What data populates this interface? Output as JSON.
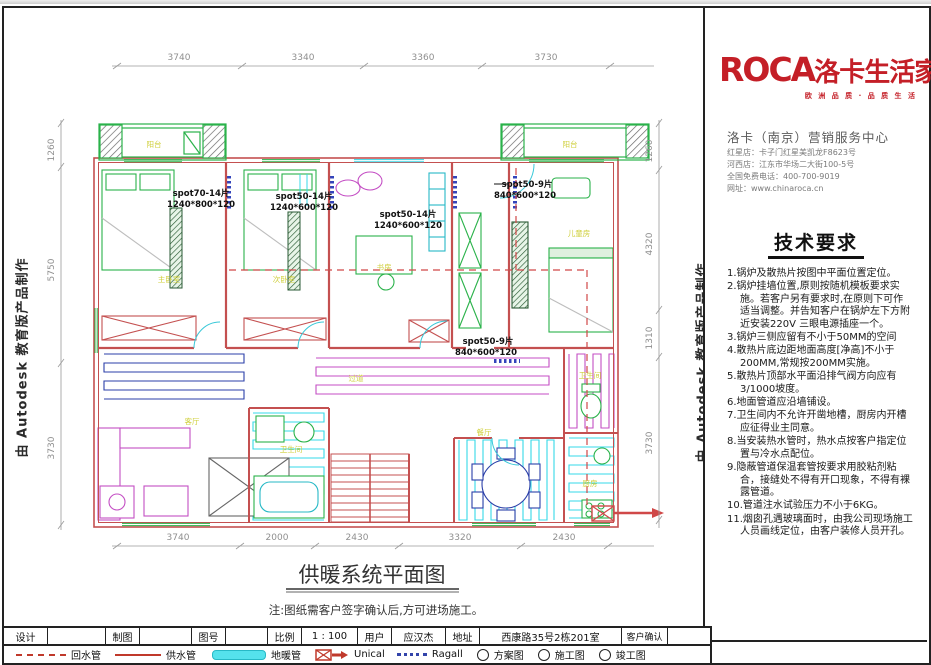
{
  "window": {
    "close_glyph": "✕"
  },
  "watermark": "由 Autodesk 教育版产品制作",
  "brand": {
    "logo_latin": "ROCA",
    "logo_cn": "洛卡生活家",
    "tagline": "欧 洲 品 质 · 品 质 生 活",
    "center_name": "洛卡（南京）营销服务中心",
    "contact_lines": [
      "红星店：卡子门红星美凯龙F8623号",
      "河西店：江东市华场二大街100-5号",
      "全国免费电话：400-700-9019",
      "网址：www.chinaroca.cn"
    ]
  },
  "tech": {
    "title": "技术要求",
    "items": [
      "1.锅炉及散热片按图中平面位置定位。",
      "2.锅炉挂墙位置,原则按随机模板要求实施。若客户另有要求时,在原则下可作适当调整。并告知客户在锅炉左下方附近安装220V 三眼电源插座一个。",
      "3.锅炉三侧应留有不小于50MM的空间",
      "4.散热片底边距地面高度[净高]不小于200MM,常规按200MM实施。",
      "5.散热片顶部水平面沿排气阀方向应有3/1000坡度。",
      "6.地面管道应沿墙铺设。",
      "7.卫生间内不允许开凿地槽，厨房内开槽应征得业主同意。",
      "8.当安装热水管时，热水点按客户指定位置与冷水点配位。",
      "9.隐蔽管道保温套管按要求用胶粘剂粘合，接缝处不得有开口现象，不得有裸露管道。",
      "10.管道注水试验压力不小于6KG。",
      "11.烟囱孔遇玻璃面时，由我公司现场施工人员画线定位，由客户装修人员开孔。"
    ]
  },
  "plan": {
    "title": "供暖系统平面图",
    "note": "注:图纸需客户签字确认后,方可进场施工。",
    "dims": {
      "top": [
        "3740",
        "3340",
        "3360",
        "3730"
      ],
      "bottom": [
        "3740",
        "2000",
        "2430",
        "3320",
        "2430"
      ],
      "left": [
        "1260",
        "5750",
        "3730"
      ],
      "right": [
        "1260",
        "4320",
        "1310",
        "3730"
      ]
    },
    "spots": [
      {
        "name": "spot70-14片",
        "size": "1240*800*120"
      },
      {
        "name": "spot50-14片",
        "size": "1240*600*120"
      },
      {
        "name": "spot50-14片",
        "size": "1240*600*120"
      },
      {
        "name": "spot50-9片",
        "size": "840*600*120"
      },
      {
        "name": "spot50-9片",
        "size": "840*600*120"
      }
    ],
    "rooms": [
      "阳台",
      "阳台",
      "主卧室",
      "次卧室",
      "书房",
      "儿童房",
      "过道",
      "客厅",
      "卫生间",
      "餐厅",
      "卫生间",
      "厨房"
    ]
  },
  "titleblock": {
    "design_label": "设计",
    "draft_label": "制图",
    "sheet_no_label": "图号",
    "scale_label": "比例",
    "scale_value": "1 : 100",
    "user_label": "用户",
    "user_value": "应汉杰",
    "address_label": "地址",
    "address_value": "西康路35号2栋201室",
    "confirm_label": "客户确认"
  },
  "legend": {
    "items": [
      {
        "label": "回水管"
      },
      {
        "label": "供水管"
      },
      {
        "label": "地暖管"
      },
      {
        "label": "Unical"
      },
      {
        "label": "Ragall"
      },
      {
        "label": "方案图"
      },
      {
        "label": "施工图"
      },
      {
        "label": "竣工图"
      }
    ]
  },
  "colors": {
    "brand_red": "#c41f27",
    "wall_red": "#c45050",
    "pipe_cyan": "#35d8e8",
    "pipe_magenta": "#c44ec4",
    "pipe_navy": "#2b3fa8",
    "furniture_green": "#2ab24a",
    "label_yellow": "#cfcf3a"
  }
}
